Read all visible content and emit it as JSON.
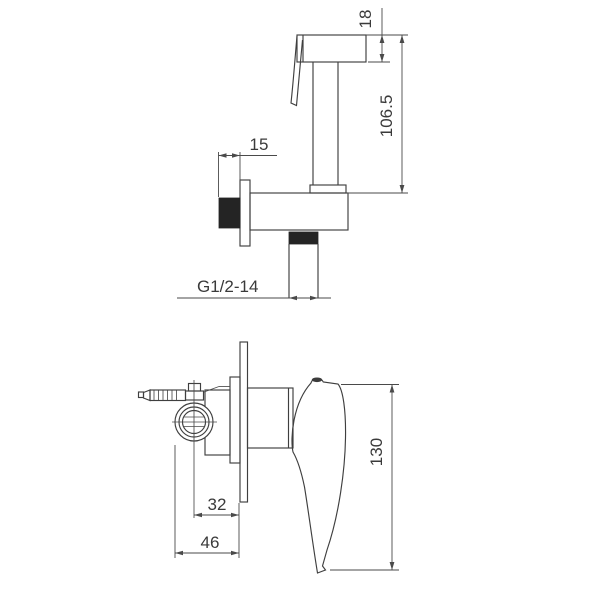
{
  "drawing": {
    "sprayer": {
      "dim_head_height": "18",
      "dim_overall_height": "106.5",
      "dim_wall_offset": "15",
      "thread_label": "G1/2-14"
    },
    "valve": {
      "dim_center_depth": "32",
      "dim_total_depth": "46",
      "dim_handle_length": "130"
    }
  },
  "colors": {
    "line": "#3f3f3f",
    "dim_line": "#4a4a4a",
    "fill_dark": "#242424",
    "background": "#ffffff"
  }
}
